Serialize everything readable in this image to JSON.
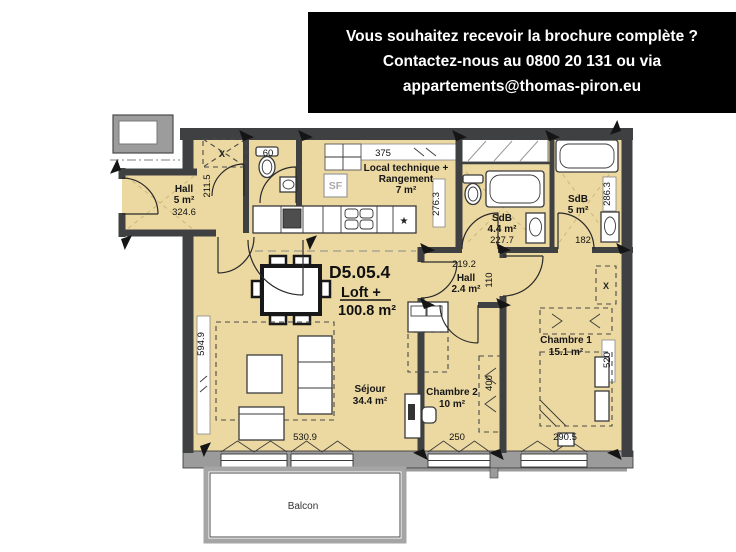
{
  "banner": {
    "line1": "Vous souhaitez recevoir la brochure complète ?",
    "line2": "Contactez-nous au 0800 20 131 ou via",
    "line3": "appartements@thomas-piron.eu",
    "bg_color": "#000000",
    "text_color": "#ffffff"
  },
  "unit": {
    "code": "D5.05.4",
    "type": "Loft +",
    "area": "100.8 m²"
  },
  "rooms": {
    "hall_entry": {
      "name": "Hall",
      "area": "5 m²"
    },
    "local_technique": {
      "line1": "Local technique +",
      "line2": "Rangement",
      "area": "7 m²"
    },
    "sdb_1": {
      "name": "SdB",
      "area": "4.4 m²"
    },
    "sdb_2": {
      "name": "SdB",
      "area": "5 m²"
    },
    "hall_2": {
      "name": "Hall",
      "area": "2.4 m²"
    },
    "sejour": {
      "name": "Séjour",
      "area": "34.4 m²"
    },
    "chambre_1": {
      "name": "Chambre 1",
      "area": "15.1 m²"
    },
    "chambre_2": {
      "name": "Chambre 2",
      "area": "10 m²"
    },
    "balcon": {
      "name": "Balcon"
    }
  },
  "dimensions": {
    "hall_width": "324.6",
    "closet_depth": "211.5",
    "wc_width": "60",
    "kitchen_counter": "375",
    "local_technique_depth": "276.3",
    "sdb_1_width": "227.7",
    "sdb_2_width": "182",
    "sdb_2_depth": "286.3",
    "hall_2_width": "219.2",
    "hall_2_depth": "110",
    "sejour_depth": "594.9",
    "sejour_width": "530.9",
    "chambre_2_width": "250",
    "chambre_2_depth": "400",
    "chambre_1_width": "290.5",
    "chambre_1_depth": "520"
  },
  "symbols": {
    "technical_unit": "SF",
    "closet_cross": "X",
    "hob_star": "★"
  },
  "colors": {
    "floor": "#ecd9a1",
    "wall": "#3f4041",
    "exterior_band": "#9b9b9b"
  }
}
